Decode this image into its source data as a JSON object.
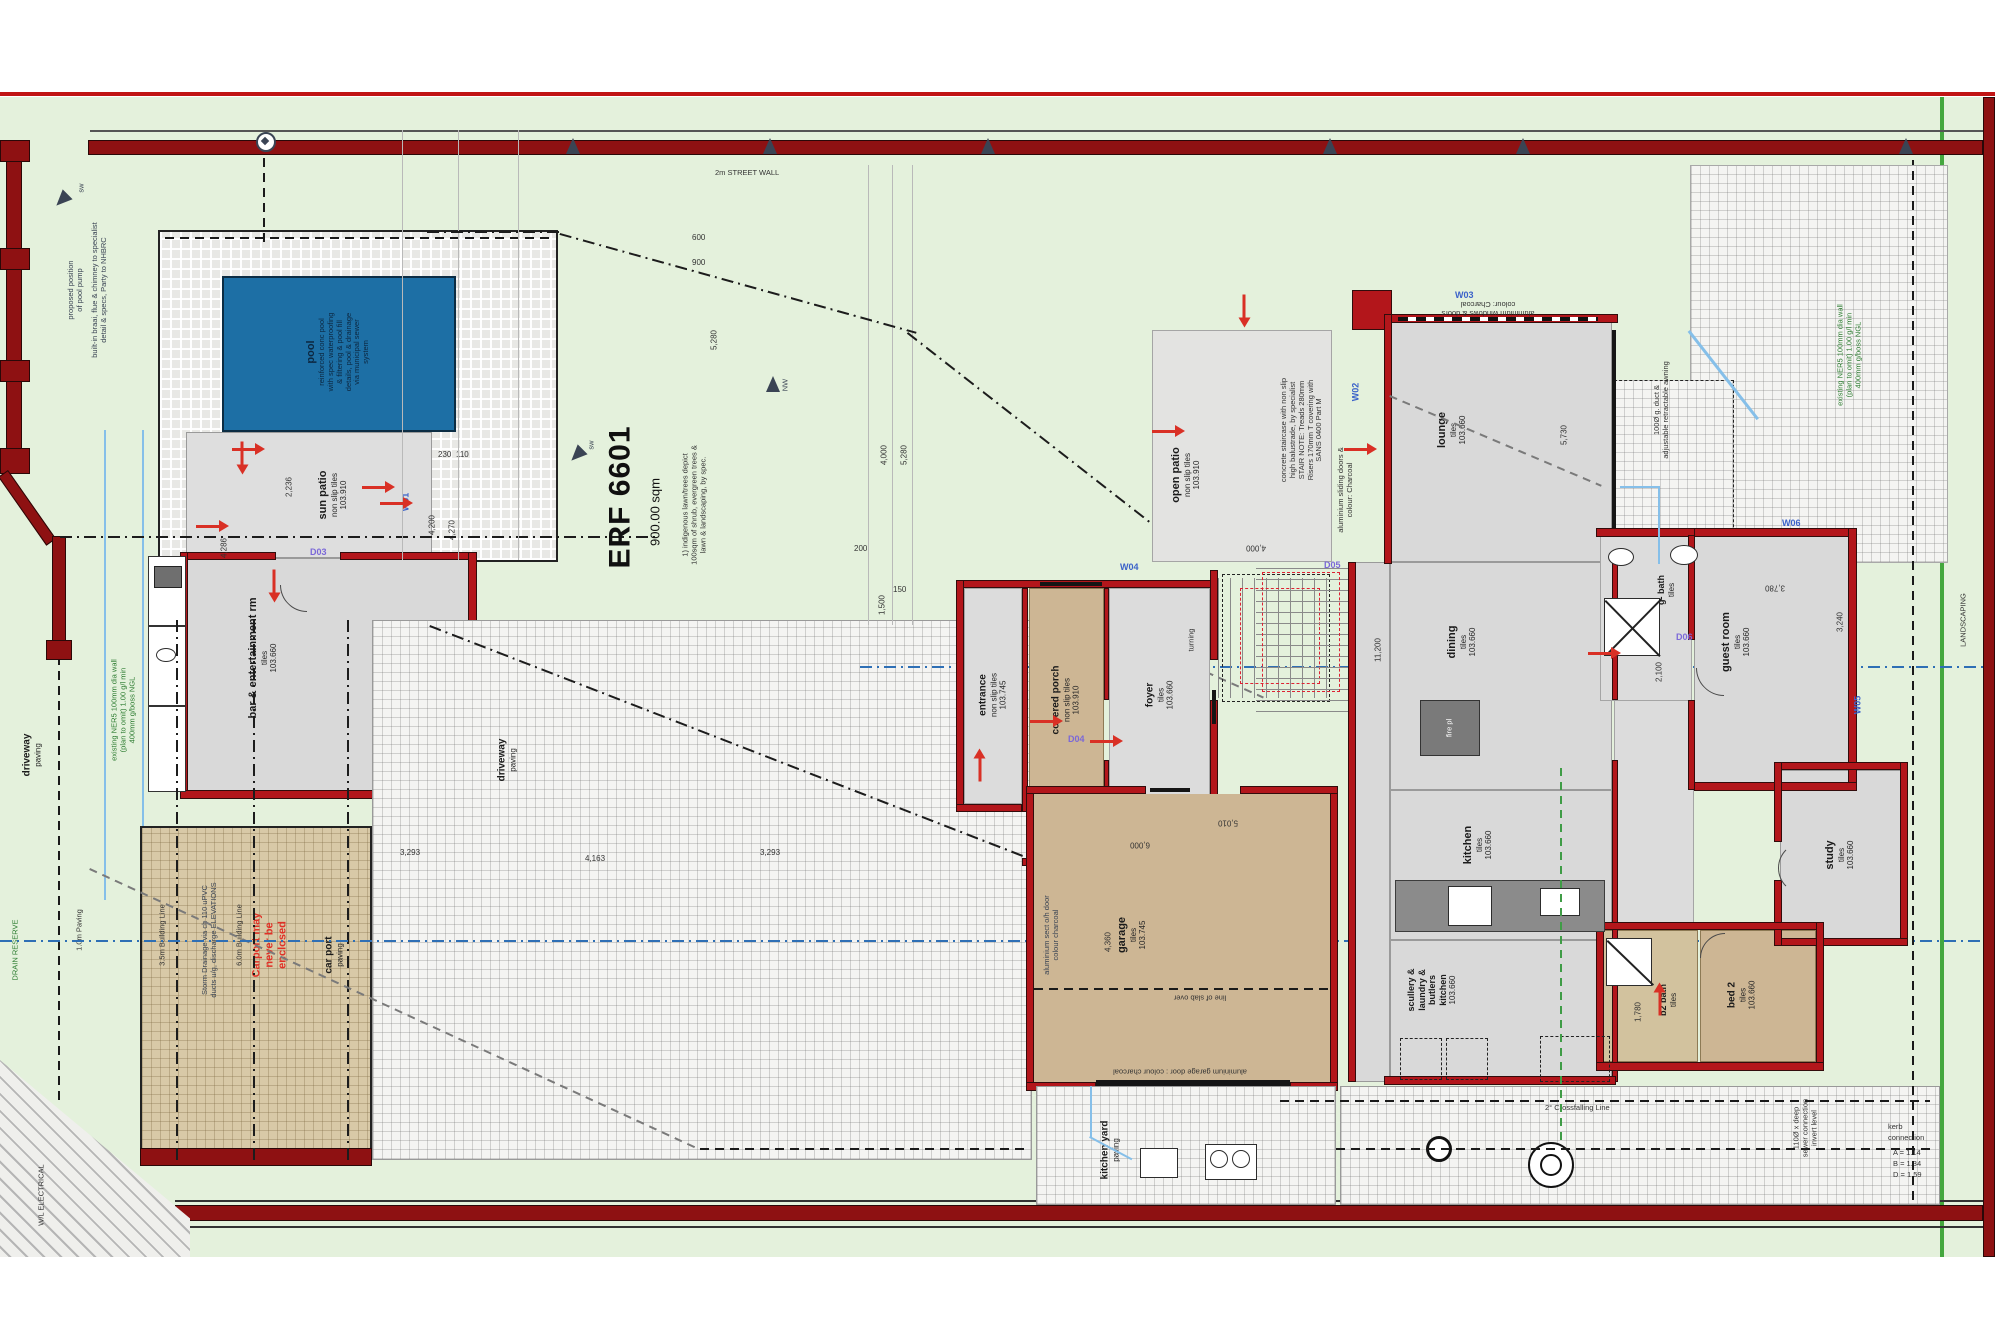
{
  "title": {
    "street_wall": "2m STREET WALL",
    "landscaping": "LANDSCAPING"
  },
  "site": {
    "erf": "ERF 6601",
    "area": "900.00 sqm",
    "notes": {
      "n1": "1) indigenous lawn/trees depict",
      "n2": "100sqm of shrub, evergreen trees &",
      "n3": "lawn & landscaping, by spec."
    }
  },
  "rooms": {
    "pool": {
      "name": "pool",
      "n1": "reinforced conc pool",
      "n2": "with spec waterproofing",
      "n3": "& filtering & pool fill",
      "n4": "details, pool & drainage",
      "n5": "via municipal sewer",
      "n6": "system"
    },
    "sun_patio": {
      "name": "sun patio",
      "finish": "non slip tiles",
      "level": "103.910"
    },
    "bar": {
      "name": "bar & entertainment rm",
      "finish": "tiles",
      "level": "103.660"
    },
    "entrance": {
      "name": "entrance",
      "finish": "non slip tiles",
      "level": "103.745"
    },
    "covered_porch": {
      "name": "covered porch",
      "finish": "non slip tiles",
      "level": "103.910"
    },
    "foyer": {
      "name": "foyer",
      "finish": "tiles",
      "level": "103.660"
    },
    "turning": "turning",
    "open_patio": {
      "name": "open patio",
      "finish": "non slip tiles",
      "level": "103.910"
    },
    "lounge": {
      "name": "lounge",
      "finish": "tiles",
      "level": "103.660"
    },
    "dining": {
      "name": "dining",
      "finish": "tiles",
      "level": "103.660"
    },
    "kitchen": {
      "name": "kitchen",
      "finish": "tiles",
      "level": "103.660"
    },
    "scullery": {
      "l1": "scullery &",
      "l2": "laundry &",
      "l3": "butlers",
      "l4": "kitchen",
      "finish": "tiles",
      "level": "103.660"
    },
    "garage": {
      "name": "garage",
      "finish": "tiles",
      "level": "103.745"
    },
    "guest_room": {
      "name": "guest room",
      "finish": "tiles",
      "level": "103.660"
    },
    "g_bath": {
      "name": "g- bath",
      "finish": "tiles",
      "level": "103.660"
    },
    "study": {
      "name": "study",
      "finish": "tiles",
      "level": "103.660"
    },
    "bed2": {
      "name": "bed 2",
      "finish": "tiles",
      "level": "103.660"
    },
    "b2_bath": {
      "name": "b2 bath",
      "finish": "tiles"
    },
    "kitchen_yard": {
      "name": "kitchen yard",
      "finish": "paving"
    },
    "carport": {
      "name": "car port",
      "finish": "paving",
      "w1": "Carport may",
      "w2": "never be",
      "w3": "enclosed"
    },
    "driveway": {
      "name": "driveway",
      "finish": "paving"
    },
    "fire": {
      "name": "fire pl"
    }
  },
  "annotations": {
    "pool_pump1": "proposed position",
    "pool_pump2": "of pool pump",
    "braai1": "built-in braai, flue & chimney to specialist",
    "braai2": "detail & specs, Party to NHBRC",
    "bl35": "3.5m Building Line",
    "bl60": "6.0m Building Line",
    "storm1": "Storm Drainage via ch 110 uPVC",
    "storm2": "ducts u/g, discharge ELEVATIONS",
    "stair1": "concrete staircase with non slip",
    "stair2": "high balustrade, by specialist",
    "stair3": "STAIR NOTE: Treads 280mm",
    "stair4": "Risers 170mm T covering with",
    "stair5": "SANS 0400 Part M",
    "slide1": "aluminium sliding doors &",
    "slide2": "colour: Charcoal",
    "win1": "aluminium windows & doors",
    "win2": "colour: Charcoal",
    "gdoor_side1": "aluminium sect o/h door",
    "gdoor_side2": "colour charcoal",
    "gdoor_bottom": "aluminium garage door : colour charcoal",
    "slab": "line of slab over",
    "high_walls": "high walls",
    "crossfall": "2° Crossfalling Line",
    "duct1": "100Ø g. duct &",
    "duct2": "adjustable retractable awning",
    "green1": "existing NER5 100mm dia wall",
    "green2": "(plan to omit) 1.00 g/l min",
    "green3": "400mm g/boss NGL",
    "sewer1": "110Ø x deep",
    "sewer2": "sewer connection",
    "sewer3": "invert level",
    "kerb1": "kerb",
    "kerb2": "connection",
    "kerbA": "A = 1.14",
    "kerbB": "B = 1.34",
    "kerbD": "D = 1.59",
    "drain_reserve": "DRAIN RESERVE",
    "paving_1m": "1.0m Paving",
    "electrical": "W/L ELECTRICAL",
    "sw": "sw",
    "nw": "NW"
  },
  "tags": {
    "w01": "W01",
    "w02": "W02",
    "w03": "W03",
    "w04": "W04",
    "w05": "W05",
    "w06": "W06",
    "d03": "D03",
    "d04": "D04",
    "d05": "D05",
    "d06": "D06",
    "d09": "D09"
  },
  "dims": {
    "d600": "600",
    "d900": "900",
    "d5280": "5,280",
    "d4000": "4,000",
    "d5730": "5,730",
    "d2236": "2,236",
    "d4286": "4,286",
    "d4200": "4,200",
    "d4270": "4,270",
    "d230": "230",
    "d110": "110",
    "d11200": "11,200",
    "d3240": "3,240",
    "d2100": "2,100",
    "d6000": "6,000",
    "d5010": "5,010",
    "d4360": "4,360",
    "d3293": "3,293",
    "d4163": "4,163",
    "d1780": "1,780",
    "d1500": "1,500",
    "d200": "200",
    "d150": "150",
    "d3780": "3,780"
  }
}
